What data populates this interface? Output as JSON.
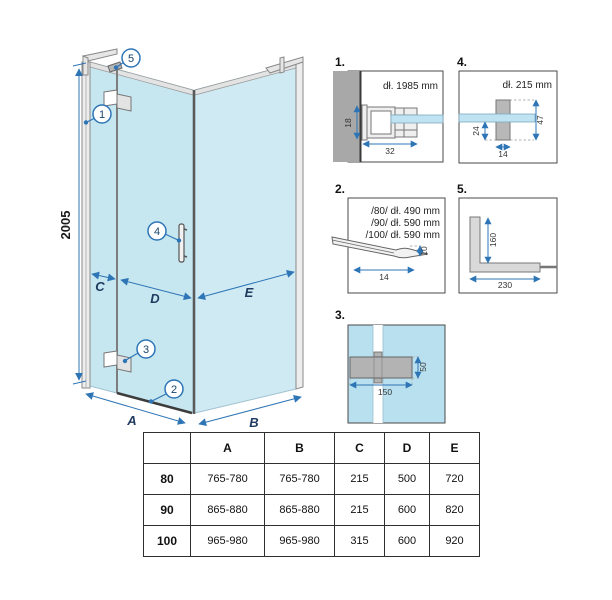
{
  "drawing": {
    "height_dim": "2005",
    "labels": {
      "a": "A",
      "b": "B",
      "c": "C",
      "d": "D",
      "e": "E"
    },
    "callouts": {
      "c1": "1",
      "c2": "2",
      "c3": "3",
      "c4": "4",
      "c5": "5"
    }
  },
  "detail1": {
    "label": "1.",
    "length": "dł. 1985 mm",
    "dim_height": "18",
    "dim_width": "32"
  },
  "detail2": {
    "label": "2.",
    "line1": "/80/ dł. 490 mm",
    "line2": "/90/ dł. 590 mm",
    "line3": "/100/ dł. 590 mm",
    "dim_height": "10",
    "dim_width": "14"
  },
  "detail3": {
    "label": "3.",
    "dim_width": "150",
    "dim_height": "50"
  },
  "detail4": {
    "label": "4.",
    "length": "dł. 215 mm",
    "dim_offset": "24",
    "dim_height": "47",
    "dim_width": "14"
  },
  "detail5": {
    "label": "5.",
    "dim_vertical": "160",
    "dim_horizontal": "230"
  },
  "table": {
    "headers": [
      "",
      "A",
      "B",
      "C",
      "D",
      "E"
    ],
    "rows": [
      {
        "label": "80",
        "values": [
          "765-780",
          "765-780",
          "215",
          "500",
          "720"
        ]
      },
      {
        "label": "90",
        "values": [
          "865-880",
          "865-880",
          "215",
          "600",
          "820"
        ]
      },
      {
        "label": "100",
        "values": [
          "965-980",
          "965-980",
          "315",
          "600",
          "920"
        ]
      }
    ]
  },
  "colors": {
    "glass": "#c6e6f0",
    "dimension_blue": "#2e75b6",
    "profile_gray": "#d9d9d9",
    "wall_gray": "#a8a8a8"
  }
}
